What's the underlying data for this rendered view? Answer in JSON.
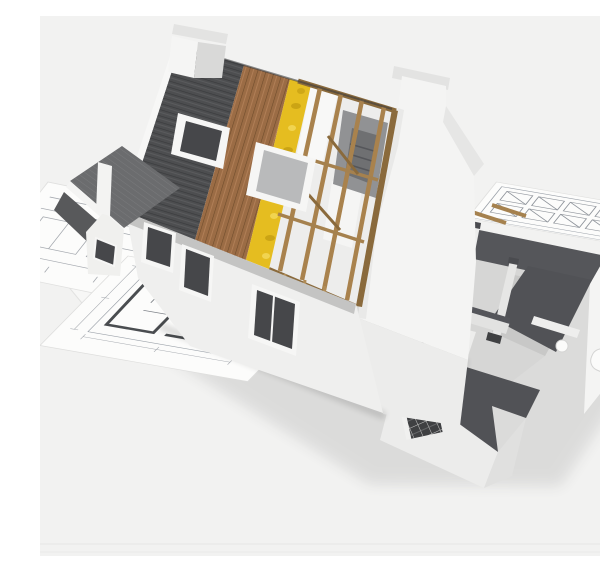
{
  "scene": {
    "description": "3D cutaway render of a house under construction resting on architectural blueprint sheets",
    "objects": [
      {
        "id": "house",
        "label": "3D house cutaway model"
      },
      {
        "id": "roof-shingles",
        "label": "Dark shingle roof layer"
      },
      {
        "id": "roof-sheathing",
        "label": "Wood plank sheathing layer"
      },
      {
        "id": "roof-insulation",
        "label": "Yellow insulation layer"
      },
      {
        "id": "roof-frame",
        "label": "Exposed timber rafters"
      },
      {
        "id": "skylights",
        "label": "Two roof windows"
      },
      {
        "id": "chimney",
        "label": "White chimney"
      },
      {
        "id": "gable-wall",
        "label": "White stepped gable end wall"
      },
      {
        "id": "facade",
        "label": "Front facade with windows"
      },
      {
        "id": "left-wing",
        "label": "Gabled side wing"
      },
      {
        "id": "interior",
        "label": "Cutaway ground-floor rooms"
      },
      {
        "id": "kitchen",
        "label": "Kitchen units"
      },
      {
        "id": "bathroom",
        "label": "Bathroom fixtures"
      },
      {
        "id": "brick-wall",
        "label": "Exposed brick wall section"
      },
      {
        "id": "blueprints",
        "label": "Architectural blueprint sheets"
      }
    ]
  },
  "palette": {
    "bg": "#f2f2f1",
    "paper": "#fcfcfb",
    "insulation": "#e5bd20",
    "wall": "#f4f4f3",
    "wall_shade": "#ececeb",
    "wall_dark": "#e0e0df",
    "facade": "#efefee",
    "cut_top": "#55565a",
    "cut_top_dark": "#515256",
    "floor": "#d6d6d5",
    "floor_dark": "#c8c8c7",
    "glass": "#46474a",
    "frame": "#f6f6f5",
    "attic": "#919294",
    "attic_dark": "#6f7072",
    "fixture": "#fbfbfa",
    "chimney_front": "#f5f5f4",
    "chimney_side": "#d9d9d8",
    "cap": "#e3e3e2",
    "wing_gable": "#f0f0ee"
  }
}
